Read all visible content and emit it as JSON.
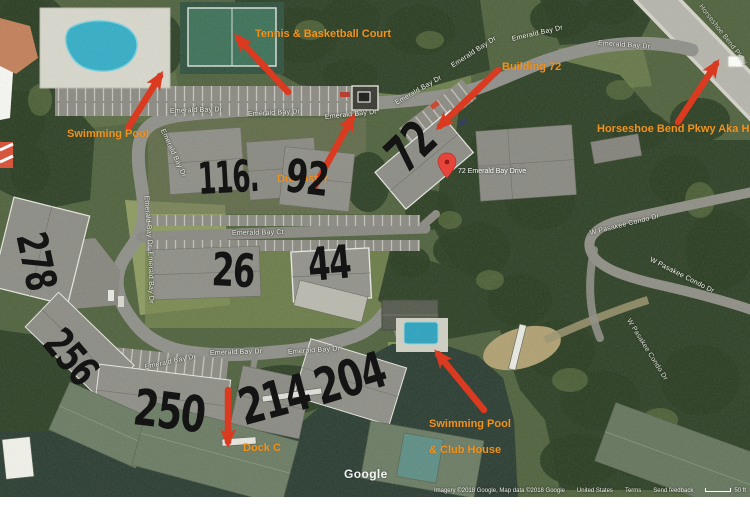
{
  "map": {
    "watermark": "Google",
    "attribution": {
      "imagery": "Imagery ©2018 Google, Map data ©2018 Google",
      "region": "United States",
      "terms": "Terms",
      "feedback": "Send feedback",
      "scale": "50 ft"
    },
    "pin_label": "72 Emerald Bay Drive",
    "roads": {
      "emerald_bay_dr": "Emerald Bay Dr",
      "emerald_bay_ct": "Emerald Bay Ct",
      "condo_dr": "W Pasakee Condo Dr",
      "parkway": "Horseshoe Bend Pkwy"
    }
  },
  "annotations": {
    "tennis_court": "Tennis & Basketball Court",
    "swimming_pool_top": "Swimming Pool",
    "building_72": "Building 72",
    "horseshoe_pkwy": "Horseshoe Bend Pkwy Aka HH",
    "dumpster": "Dumpster",
    "dock_c": "Dock C",
    "pool_club_line1": "Swimming Pool",
    "pool_club_line2": "& Club House"
  },
  "handwritten_numbers": {
    "n116": "116.",
    "n92": "92",
    "n72": "72",
    "n26": "26",
    "n44": "44",
    "n278": "278",
    "n256": "256",
    "n250": "250",
    "n214": "214",
    "n204": "204"
  },
  "colors": {
    "annotation_orange": "#f0931f",
    "arrow_red": "#d93a20",
    "ink_black": "#141414",
    "water": "#2c3e33",
    "road": "#90908a"
  }
}
